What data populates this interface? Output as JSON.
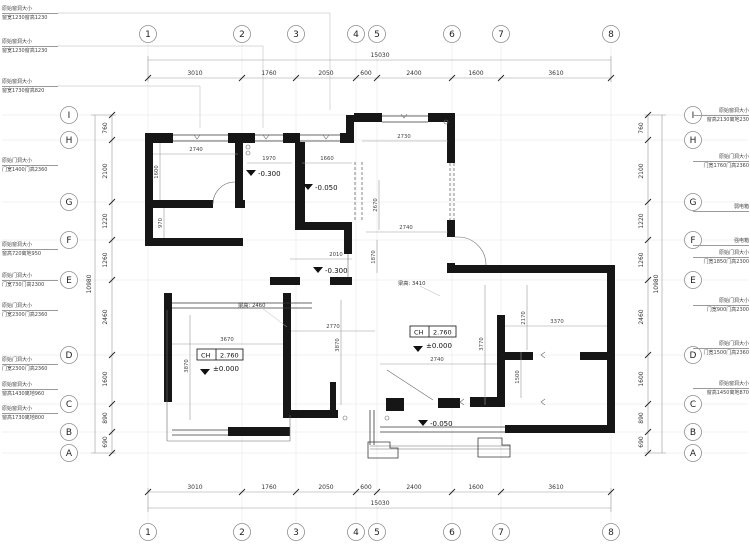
{
  "drawing": {
    "type": "floor-plan"
  },
  "grid": {
    "cols": [
      "1",
      "2",
      "3",
      "4",
      "5",
      "6",
      "7",
      "8"
    ],
    "rows": [
      "I",
      "H",
      "G",
      "F",
      "E",
      "D",
      "C",
      "B",
      "A"
    ]
  },
  "dims": {
    "top": [
      "3010",
      "1760",
      "2050",
      "600",
      "2400",
      "1600",
      "3610"
    ],
    "bottom": [
      "3010",
      "1760",
      "2050",
      "600",
      "2400",
      "1600",
      "3610"
    ],
    "top_total": "15030",
    "bottom_total": "15030",
    "left": [
      "760",
      "2100",
      "1220",
      "1260",
      "2460",
      "1600",
      "890",
      "690"
    ],
    "right": [
      "760",
      "2100",
      "1220",
      "1260",
      "2460",
      "1600",
      "890",
      "690"
    ],
    "left_total": "10980",
    "right_total": "10980"
  },
  "plan": {
    "dims": [
      "2740",
      "1600",
      "970",
      "1970",
      "1660",
      "2730",
      "2670",
      "2740",
      "1870",
      "2010",
      "3670",
      "3870",
      "2770",
      "3870",
      "2170",
      "3370",
      "3770",
      "2740",
      "1500"
    ],
    "levels": [
      "-0.300",
      "-0.050",
      "-0.300",
      "-0.050"
    ],
    "ch": {
      "label": "CH",
      "value": "2.760",
      "datum": "±0.000"
    },
    "beams": [
      "梁高: 2460",
      "梁高: 3410"
    ]
  },
  "annotations": {
    "left": [
      {
        "l1": "原始窗洞大小",
        "l2": "窗宽1230窗高1230"
      },
      {
        "l1": "原始窗洞大小",
        "l2": "窗宽1230窗高1230"
      },
      {
        "l1": "原始窗洞大小",
        "l2": "窗宽1730窗高820"
      },
      {
        "l1": "原始门洞大小",
        "l2": "门宽1400门高2360"
      },
      {
        "l1": "原始窗洞大小",
        "l2": "窗高720离地950"
      },
      {
        "l1": "原始门洞大小",
        "l2": "门宽730门高2300"
      },
      {
        "l1": "原始门洞大小",
        "l2": "门宽2300门高2360"
      },
      {
        "l1": "原始门洞大小",
        "l2": "门宽2300门高2360"
      },
      {
        "l1": "原始窗洞大小",
        "l2": "窗高1430离地960"
      },
      {
        "l1": "原始窗洞大小",
        "l2": "窗高1730离地800"
      }
    ],
    "right": [
      {
        "l1": "原始窗洞大小",
        "l2": "窗高2130离地230"
      },
      {
        "l1": "原始门洞大小",
        "l2": "门宽1760门高2360"
      },
      {
        "l1": "弱电箱",
        "l2": ""
      },
      {
        "l1": "强电箱",
        "l2": ""
      },
      {
        "l1": "原始门洞大小",
        "l2": "门宽1850门高2300"
      },
      {
        "l1": "原始门洞大小",
        "l2": "门宽900门高2300"
      },
      {
        "l1": "原始门洞大小",
        "l2": "门宽1500门高2360"
      },
      {
        "l1": "原始窗洞大小",
        "l2": "窗高1450离地870"
      }
    ]
  }
}
